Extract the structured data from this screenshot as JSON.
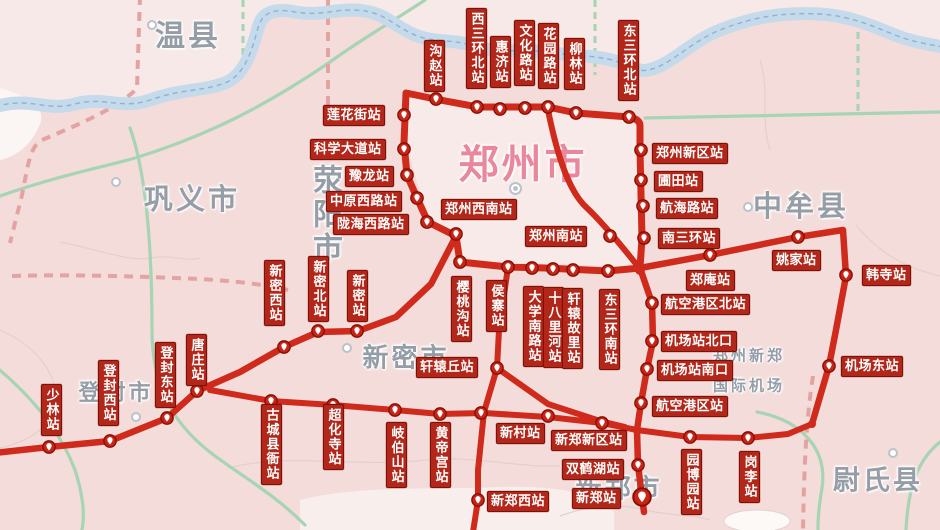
{
  "map": {
    "title": "郑州地区轨道交通线路示意图",
    "colors": {
      "rail": "#cf2a1c",
      "station_label_bg": "#b2271a",
      "station_label_text": "#ffffff",
      "road_green": "#a6d4b4",
      "boundary_pink": "#e4a3a3",
      "river_blue": "#c5daea",
      "city_text_gray": "#959da7",
      "zhengzhou_pink": "#e9879c",
      "background": "#f3dcda"
    },
    "cities": [
      {
        "name": "温县",
        "x": 188,
        "y": 33,
        "size": 30,
        "marker": {
          "x": 152,
          "y": 25
        }
      },
      {
        "name": "巩义市",
        "x": 192,
        "y": 197,
        "size": 29,
        "marker": {
          "x": 116,
          "y": 182
        }
      },
      {
        "name": "荥阳市",
        "x": 324,
        "y": 215,
        "size": 30,
        "vertical": true
      },
      {
        "name": "郑州市",
        "x": 523,
        "y": 161,
        "size": 40,
        "color": "#e9879c",
        "marker": {
          "x": 515,
          "y": 188,
          "major": true
        }
      },
      {
        "name": "中牟县",
        "x": 801,
        "y": 204,
        "size": 29,
        "marker": {
          "x": 748,
          "y": 207
        }
      },
      {
        "name": "登封市",
        "x": 116,
        "y": 391,
        "size": 22,
        "marker": {
          "x": 136,
          "y": 417
        }
      },
      {
        "name": "新密市",
        "x": 406,
        "y": 356,
        "size": 26,
        "marker": {
          "x": 347,
          "y": 348
        }
      },
      {
        "name": "新郑市",
        "x": 619,
        "y": 487,
        "size": 26
      },
      {
        "name": "尉氏县",
        "x": 878,
        "y": 478,
        "size": 27,
        "marker": {
          "x": 893,
          "y": 453
        }
      },
      {
        "name": "郑州新郑",
        "x": 749,
        "y": 355,
        "size": 15
      },
      {
        "name": "国际机场",
        "x": 749,
        "y": 385,
        "size": 15
      }
    ],
    "airport_icon": {
      "x": 672,
      "y": 366,
      "glyph": "✈"
    },
    "stations": [
      {
        "name": "沟赵站",
        "o": "v",
        "lx": 424,
        "ly": 40,
        "mx": 436,
        "my": 99
      },
      {
        "name": "西三环北站",
        "o": "v",
        "lx": 466,
        "ly": 8,
        "mx": 477,
        "my": 107
      },
      {
        "name": "惠济站",
        "o": "v",
        "lx": 490,
        "ly": 36,
        "mx": 500,
        "my": 109
      },
      {
        "name": "文化路站",
        "o": "v",
        "lx": 514,
        "ly": 20,
        "mx": 525,
        "my": 108
      },
      {
        "name": "花园路站",
        "o": "v",
        "lx": 538,
        "ly": 23,
        "mx": 548,
        "my": 107
      },
      {
        "name": "柳林站",
        "o": "v",
        "lx": 564,
        "ly": 38,
        "mx": 576,
        "my": 113
      },
      {
        "name": "东三环北站",
        "o": "v",
        "lx": 618,
        "ly": 20,
        "mx": 629,
        "my": 117
      },
      {
        "name": "莲花街站",
        "o": "h",
        "lx": 323,
        "ly": 105,
        "mx": 404,
        "my": 115
      },
      {
        "name": "科学大道站",
        "o": "h",
        "lx": 310,
        "ly": 139,
        "mx": 404,
        "my": 149
      },
      {
        "name": "豫龙站",
        "o": "h",
        "lx": 345,
        "ly": 166,
        "mx": 407,
        "my": 175
      },
      {
        "name": "中原西路站",
        "o": "h",
        "lx": 326,
        "ly": 191,
        "mx": 417,
        "my": 198
      },
      {
        "name": "陇海西路站",
        "o": "h",
        "lx": 333,
        "ly": 214,
        "mx": 427,
        "my": 222
      },
      {
        "name": "郑州西南站",
        "o": "h",
        "lx": 441,
        "ly": 199,
        "mx": 456,
        "my": 234
      },
      {
        "name": "郑州南站",
        "o": "h",
        "lx": 525,
        "ly": 226,
        "mx": 610,
        "my": 236
      },
      {
        "name": "樱桃沟站",
        "o": "v",
        "lx": 451,
        "ly": 276,
        "mx": 460,
        "my": 262
      },
      {
        "name": "侯寨站",
        "o": "v",
        "lx": 486,
        "ly": 280,
        "mx": 508,
        "my": 267
      },
      {
        "name": "大学南路站",
        "o": "v",
        "lx": 523,
        "ly": 286,
        "mx": 532,
        "my": 268
      },
      {
        "name": "十八里河站",
        "o": "v",
        "lx": 543,
        "ly": 287,
        "mx": 553,
        "my": 269
      },
      {
        "name": "轩辕故里站",
        "o": "v",
        "lx": 562,
        "ly": 288,
        "mx": 573,
        "my": 270
      },
      {
        "name": "东三环南站",
        "o": "v",
        "lx": 599,
        "ly": 289,
        "mx": 608,
        "my": 271
      },
      {
        "name": "郑州新区站",
        "o": "h",
        "lx": 652,
        "ly": 143,
        "mx": 641,
        "my": 150
      },
      {
        "name": "圃田站",
        "o": "h",
        "lx": 654,
        "ly": 171,
        "mx": 641,
        "my": 180
      },
      {
        "name": "航海路站",
        "o": "h",
        "lx": 656,
        "ly": 198,
        "mx": 643,
        "my": 206
      },
      {
        "name": "南三环站",
        "o": "h",
        "lx": 658,
        "ly": 228,
        "mx": 644,
        "my": 238
      },
      {
        "name": "郑庵站",
        "o": "h",
        "lx": 686,
        "ly": 270,
        "mx": 710,
        "my": 255
      },
      {
        "name": "姚家站",
        "o": "h",
        "lx": 772,
        "ly": 250,
        "mx": 798,
        "my": 237
      },
      {
        "name": "韩寺站",
        "o": "h",
        "lx": 862,
        "ly": 265,
        "mx": 846,
        "my": 275
      },
      {
        "name": "机场东站",
        "o": "h",
        "lx": 841,
        "ly": 356,
        "mx": 829,
        "my": 366
      },
      {
        "name": "航空港区北站",
        "o": "h",
        "lx": 661,
        "ly": 294,
        "mx": 652,
        "my": 303
      },
      {
        "name": "机场站北口",
        "o": "h",
        "lx": 661,
        "ly": 331,
        "mx": 652,
        "my": 341
      },
      {
        "name": "机场站南口",
        "o": "h",
        "lx": 657,
        "ly": 360,
        "mx": 647,
        "my": 369
      },
      {
        "name": "航空港区站",
        "o": "h",
        "lx": 652,
        "ly": 396,
        "mx": 641,
        "my": 403
      },
      {
        "name": "新郑新区站",
        "o": "h",
        "lx": 551,
        "ly": 430,
        "mx": 602,
        "my": 423
      },
      {
        "name": "双鹤湖站",
        "o": "h",
        "lx": 562,
        "ly": 459,
        "mx": 638,
        "my": 465
      },
      {
        "name": "新郑站",
        "o": "h",
        "lx": 572,
        "ly": 488,
        "mx": 642,
        "my": 497,
        "big": true
      },
      {
        "name": "园博园站",
        "o": "v",
        "lx": 681,
        "ly": 449,
        "mx": 690,
        "my": 437
      },
      {
        "name": "岗李站",
        "o": "v",
        "lx": 739,
        "ly": 451,
        "mx": 748,
        "my": 438
      },
      {
        "name": "新村站",
        "o": "h",
        "lx": 496,
        "ly": 423,
        "mx": 481,
        "my": 413
      },
      {
        "name": "新郑西站",
        "o": "h",
        "lx": 487,
        "ly": 491,
        "mx": 478,
        "my": 500
      },
      {
        "name": "轩辕丘站",
        "o": "h",
        "lx": 416,
        "ly": 357,
        "mx": 497,
        "my": 368
      },
      {
        "name": "岐伯山站",
        "o": "v",
        "lx": 386,
        "ly": 422,
        "mx": 395,
        "my": 410
      },
      {
        "name": "黄帝宫站",
        "o": "v",
        "lx": 430,
        "ly": 422,
        "mx": 440,
        "my": 414
      },
      {
        "name": "超化寺站",
        "o": "v",
        "lx": 323,
        "ly": 404,
        "mx": 333,
        "my": 405
      },
      {
        "name": "古城县衙站",
        "o": "v",
        "lx": 261,
        "ly": 404,
        "mx": 271,
        "my": 401
      },
      {
        "name": "新密站",
        "o": "v",
        "lx": 347,
        "ly": 270,
        "mx": 357,
        "my": 331
      },
      {
        "name": "新密北站",
        "o": "v",
        "lx": 308,
        "ly": 256,
        "mx": 318,
        "my": 331
      },
      {
        "name": "新密西站",
        "o": "v",
        "lx": 264,
        "ly": 260,
        "mx": 284,
        "my": 347
      },
      {
        "name": "唐庄站",
        "o": "v",
        "lx": 186,
        "ly": 334,
        "mx": 197,
        "my": 391
      },
      {
        "name": "登封东站",
        "o": "v",
        "lx": 155,
        "ly": 342,
        "mx": 167,
        "my": 418
      },
      {
        "name": "登封西站",
        "o": "v",
        "lx": 98,
        "ly": 360,
        "mx": 110,
        "my": 441
      },
      {
        "name": "少林站",
        "o": "v",
        "lx": 41,
        "ly": 384,
        "mx": 49,
        "my": 447
      }
    ],
    "extra_markers": [
      {
        "x": 548,
        "y": 416
      }
    ]
  }
}
